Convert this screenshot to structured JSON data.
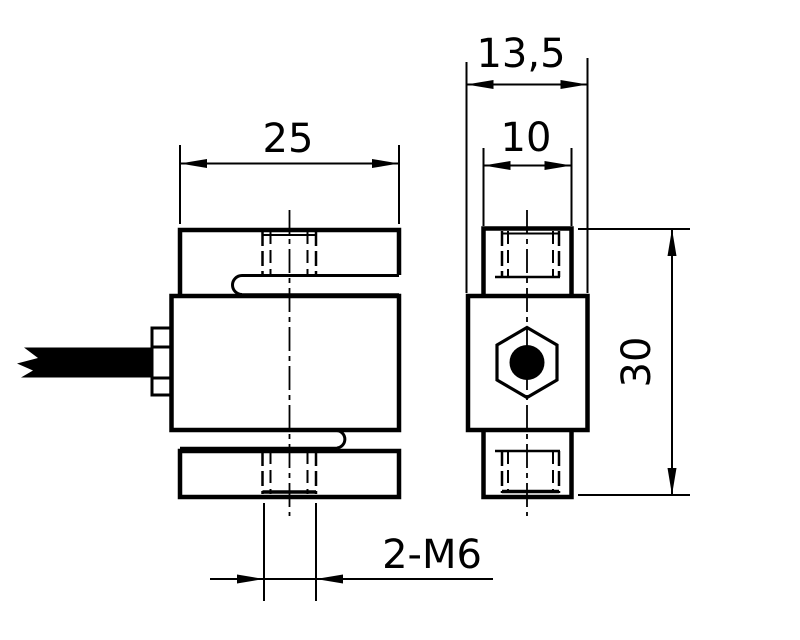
{
  "drawing": {
    "labels": {
      "front_width": "25",
      "depth": "13,5",
      "boss_width": "10",
      "height": "30",
      "thread_callout": "2-M6"
    },
    "colors": {
      "line": "#000000",
      "background": "#ffffff"
    }
  }
}
